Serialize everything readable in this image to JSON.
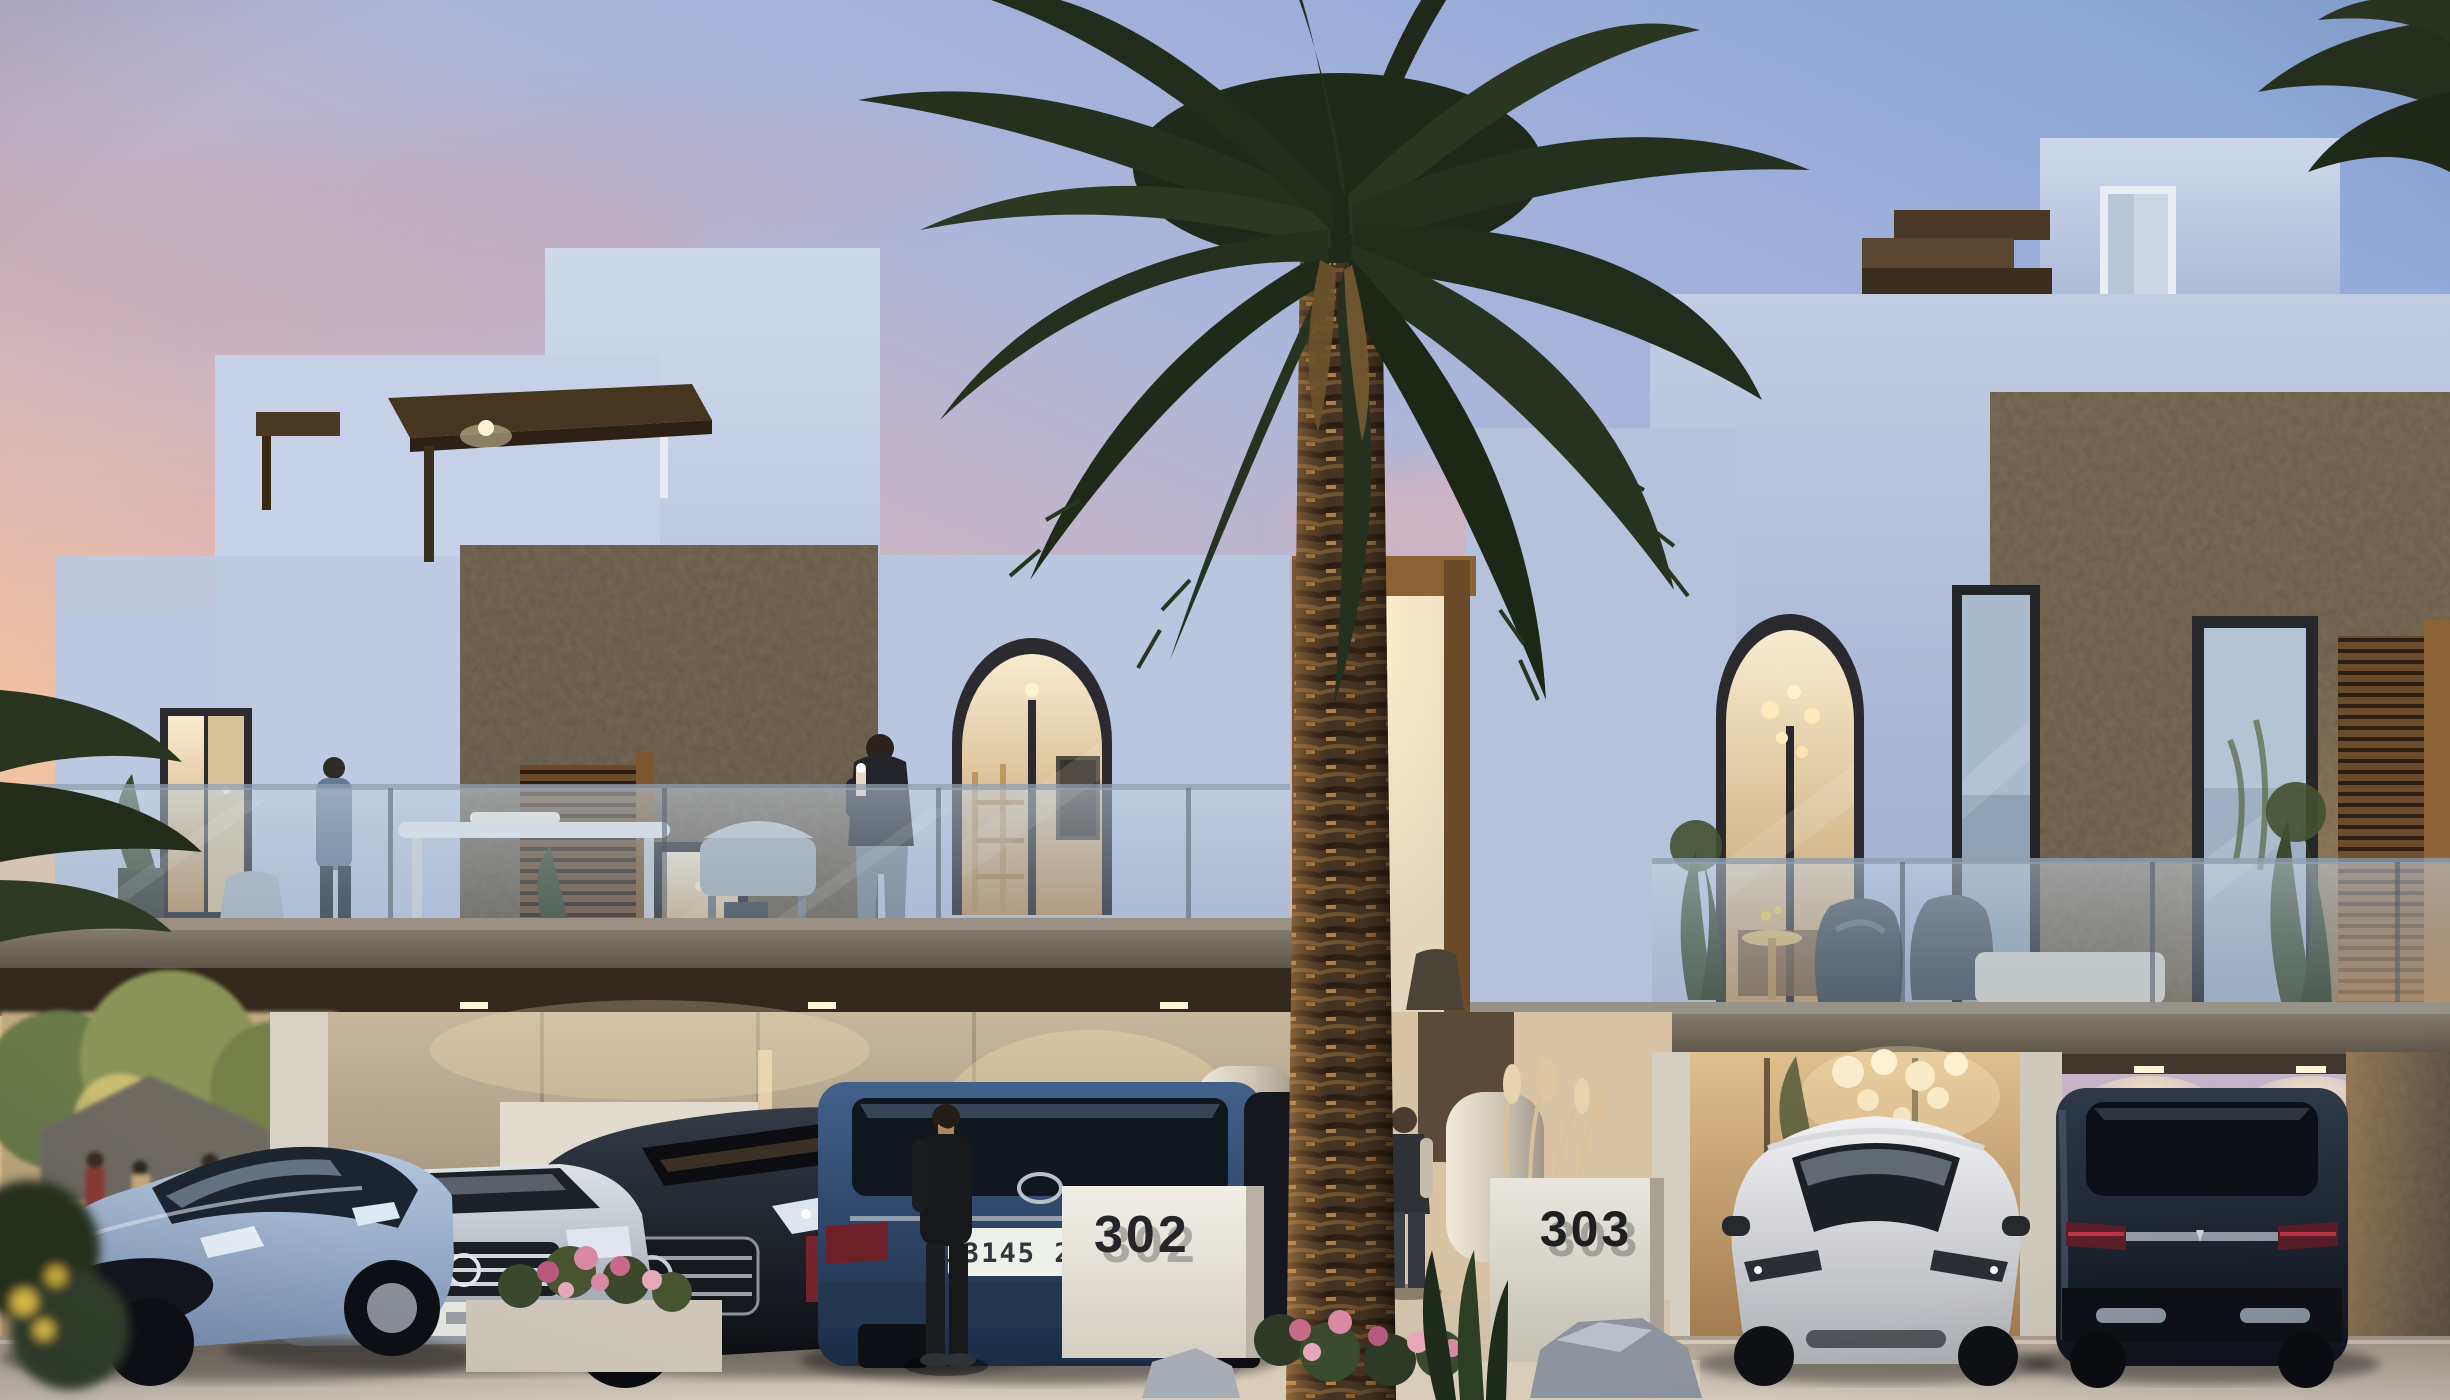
{
  "scene": {
    "description": "Twilight architectural rendering of modern white Mediterranean-style townhouses with stone accent walls, balconies, carports with luxury cars and a large date palm in the foreground",
    "time_of_day": "sunset dusk",
    "house_numbers": {
      "left": "302",
      "right": "303"
    },
    "license_plate": "33145 2357",
    "palette": {
      "sky_blue": "#8da8d8",
      "sky_pink": "#e9bba8",
      "sky_gold": "#fbd49c",
      "facade_white": "#c2cde4",
      "stone_beige": "#8a7e6c",
      "wood_brown": "#5a4530",
      "warm_light": "#f9ecd0",
      "slab_concrete": "#7c7264",
      "glass_blue": "#b9c6d4",
      "palm_green": "#25301e",
      "road_gray": "#b5ab9d",
      "flower_pink": "#d889a4"
    },
    "people": [
      {
        "label": "man-on-balcony-with-phone",
        "location": "balcony of unit 302"
      },
      {
        "label": "person-blue-jacket",
        "location": "left balcony doorway"
      },
      {
        "label": "man-in-black",
        "location": "standing beside blue SUV"
      },
      {
        "label": "man-in-vest",
        "location": "walkway beside palm near unit 303"
      },
      {
        "label": "cafe-guests",
        "location": "street scene far left background"
      }
    ],
    "cars": [
      {
        "label": "light-blue-sedan",
        "view": "front-three-quarter",
        "position": "left carport bay 1"
      },
      {
        "label": "silver-sedan",
        "view": "front",
        "position": "left carport bay 2"
      },
      {
        "label": "black-sedan",
        "view": "front-three-quarter",
        "position": "left carport bay 3"
      },
      {
        "label": "blue-suv",
        "view": "rear",
        "position": "left carport bay 4",
        "plate": "33145 2357"
      },
      {
        "label": "white-crossover",
        "view": "front",
        "position": "right carport bay 1"
      },
      {
        "label": "dark-suv",
        "view": "rear",
        "position": "right carport bay 2"
      }
    ],
    "landscape": {
      "palm": "large date palm centered in foreground",
      "flowers": "pink blossoms along walkway and planter",
      "grasses": "pampas plumes beside house-number walls",
      "rock": "gray boulder beside 303 wall"
    }
  }
}
